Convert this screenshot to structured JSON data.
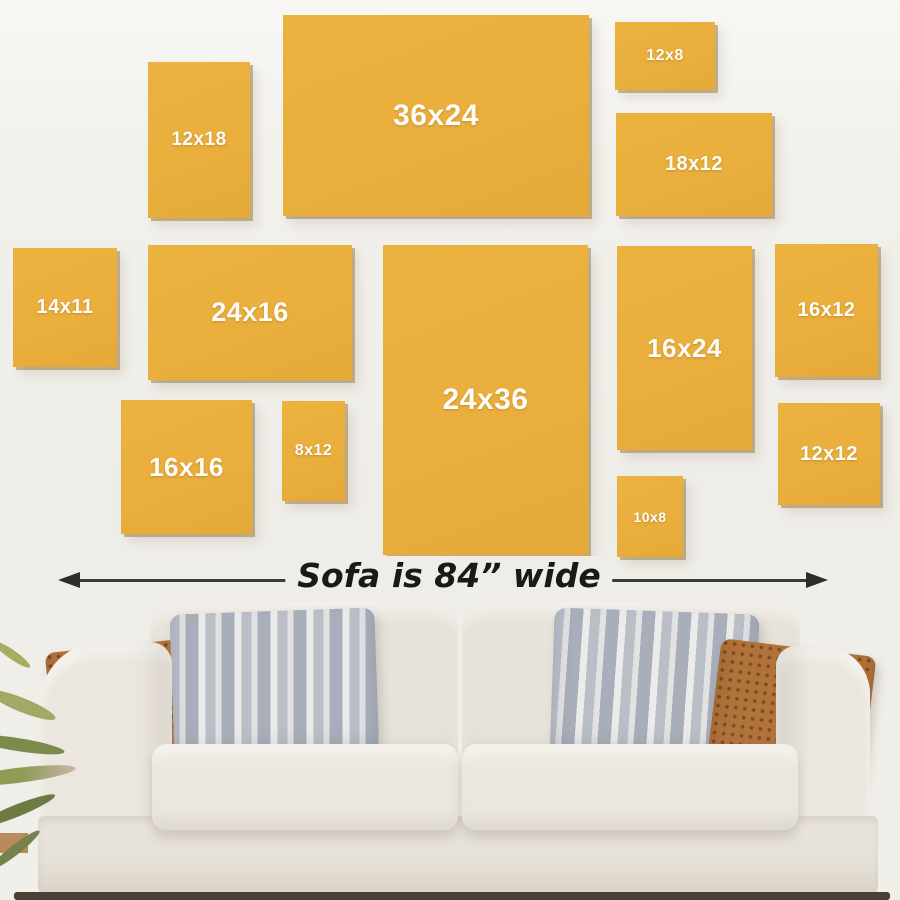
{
  "frames": [
    {
      "label": "12x18"
    },
    {
      "label": "36x24"
    },
    {
      "label": "12x8"
    },
    {
      "label": "18x12"
    },
    {
      "label": "14x11"
    },
    {
      "label": "24x16"
    },
    {
      "label": "24x36"
    },
    {
      "label": "16x24"
    },
    {
      "label": "16x12"
    },
    {
      "label": "16x16"
    },
    {
      "label": "8x12"
    },
    {
      "label": "10x8"
    },
    {
      "label": "12x12"
    }
  ],
  "caption": {
    "text": "Sofa is 84” wide"
  },
  "colors": {
    "frame_gold": "#ECB23F",
    "wall": "#F1EFEA",
    "sofa_fabric": "#E9E4DC",
    "pillow_brown": "#B1733C",
    "pillow_gray": "#C5C9D0",
    "arrow": "#2E2D2B",
    "label_text": "#FDFCF8"
  }
}
